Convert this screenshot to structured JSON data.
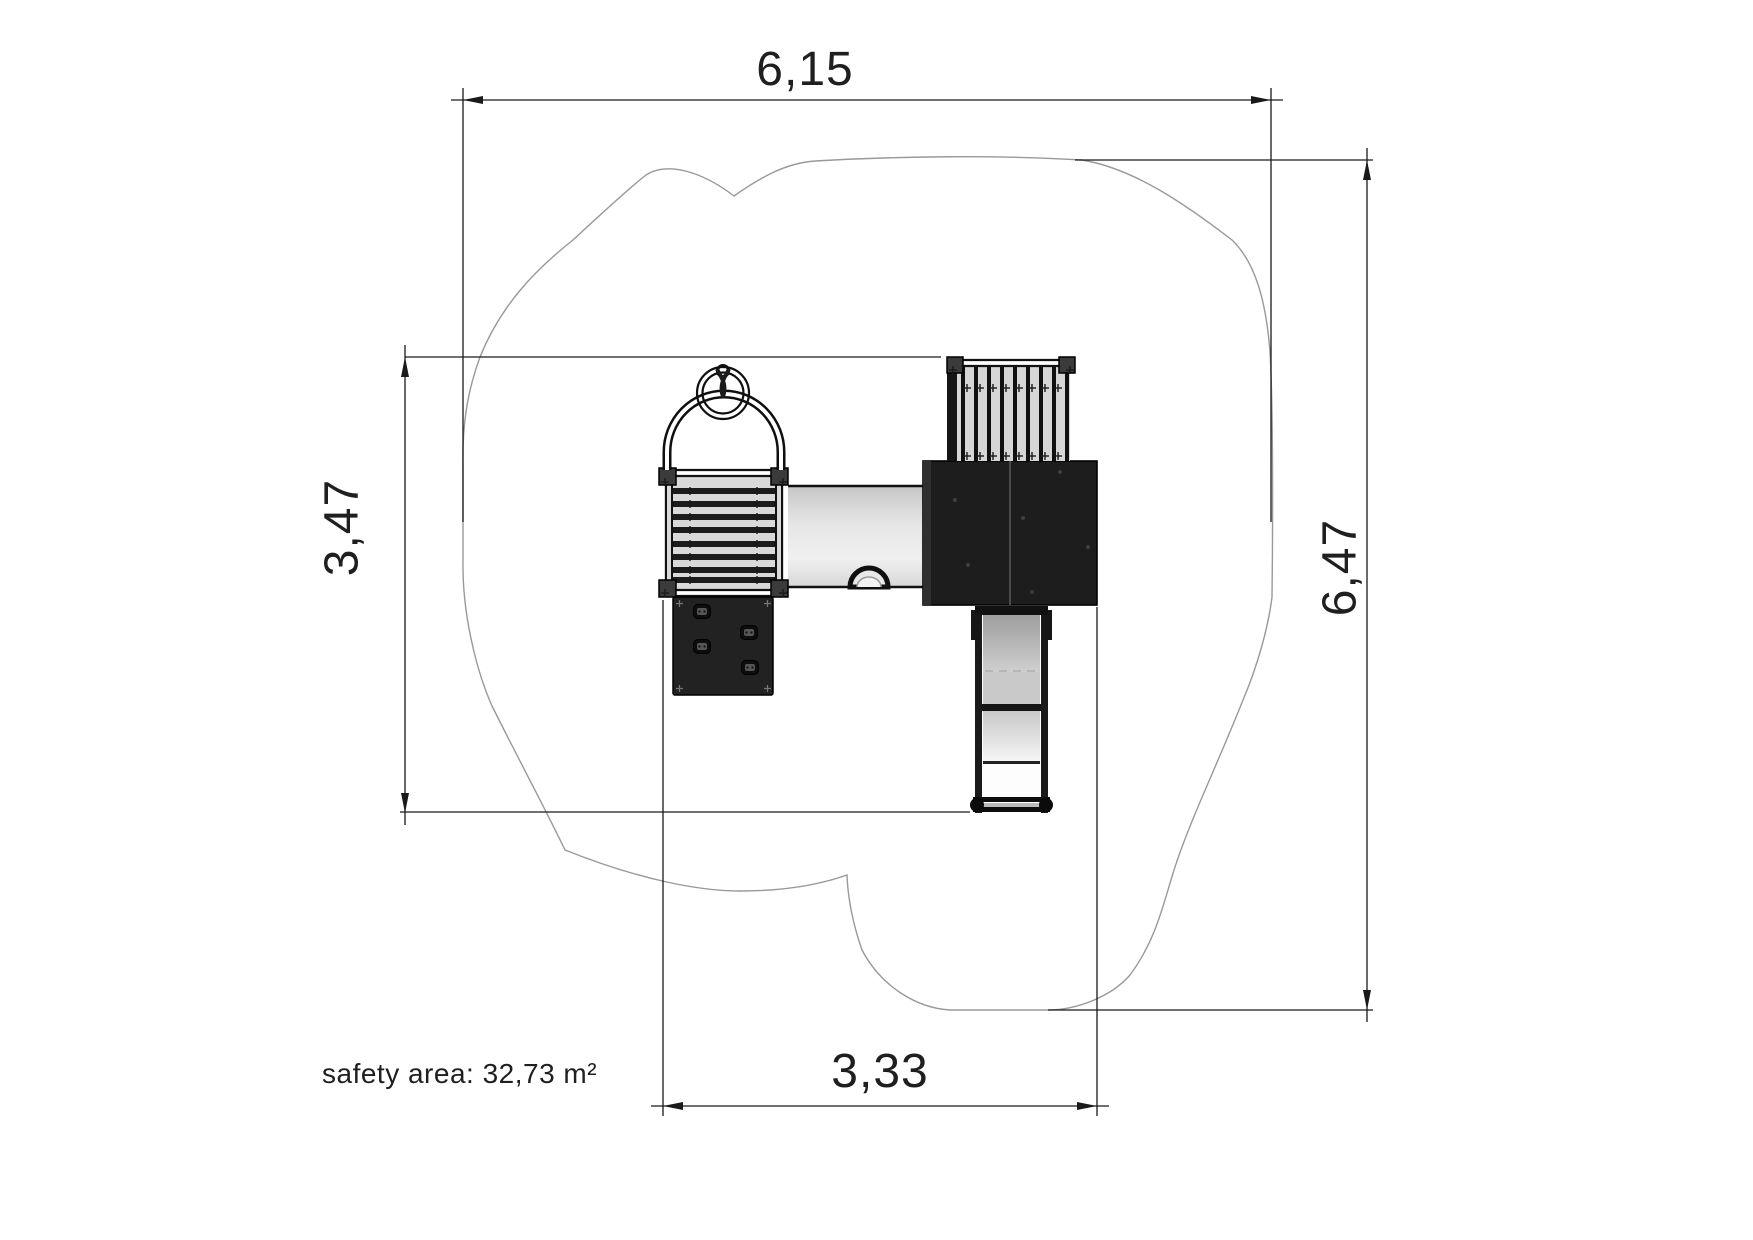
{
  "drawing": {
    "kind": "playground equipment plan view with safety area",
    "dimensions": {
      "top_width": "6,15",
      "right_height": "6,47",
      "left_height": "3,47",
      "bottom_width": "3,33"
    },
    "labels": {
      "safety_area": "safety area: 32,73 m²"
    },
    "values": {
      "top_width_m": 6.15,
      "right_height_m": 6.47,
      "left_height_m": 3.47,
      "bottom_width_m": 3.33,
      "safety_area_m2": 32.73
    },
    "colors": {
      "line": "#1a1a1a",
      "safety_boundary": "#999999",
      "deck_dark": "#1d1d1d",
      "panel_dark": "#222222",
      "platform_grey": "#d9d9d9",
      "tunnel_grey": "#dedede",
      "background": "#ffffff"
    }
  }
}
